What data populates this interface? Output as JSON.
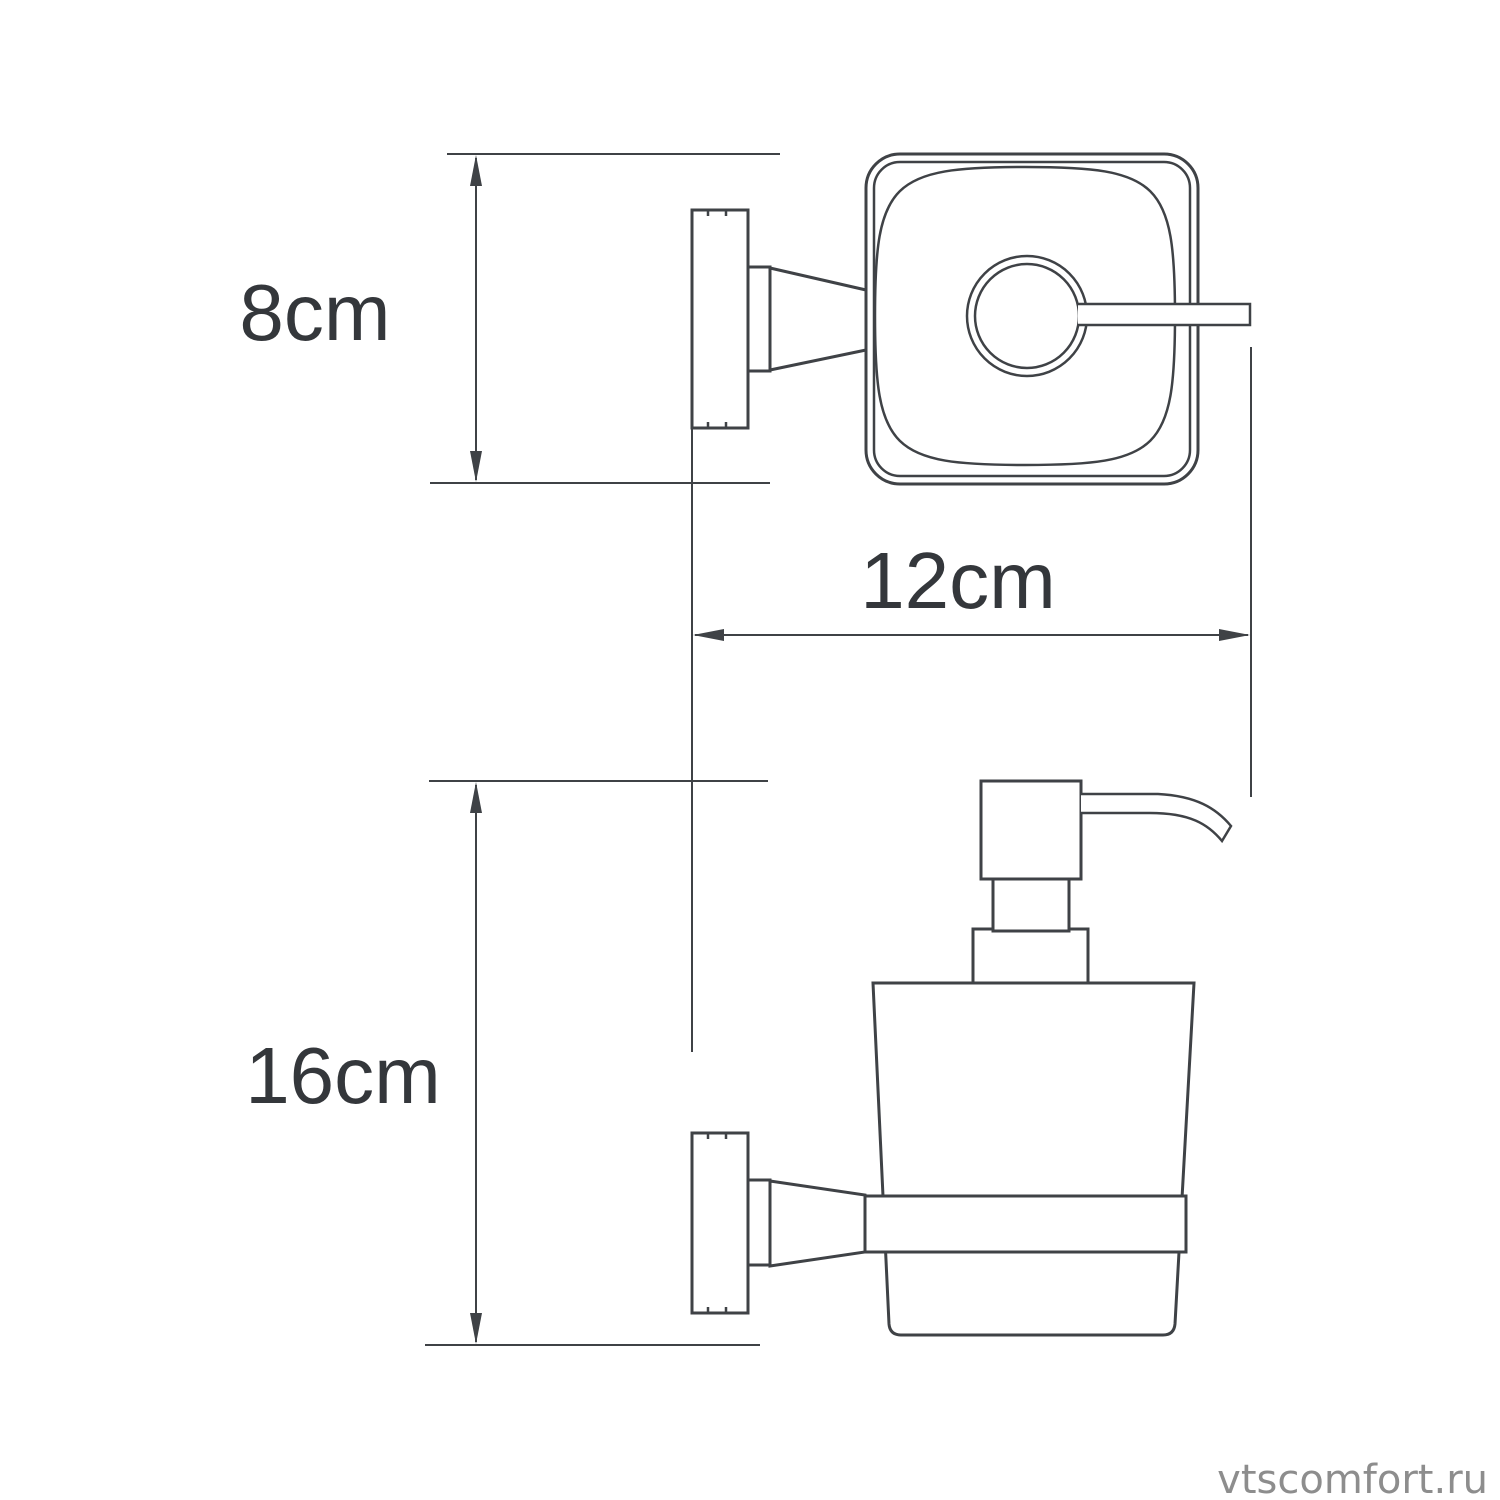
{
  "colors": {
    "line": "#3f4246",
    "text": "#34373b",
    "watermark": "#8d8d8d",
    "bg": "#ffffff"
  },
  "drawing": {
    "type": "technical-dimension-diagram",
    "product": "wall-mounted soap dispenser (top view and side view)",
    "dimensions": [
      {
        "id": "top-view-depth",
        "label": "8cm",
        "orientation": "vertical"
      },
      {
        "id": "wall-to-spout-width",
        "label": "12cm",
        "orientation": "horizontal"
      },
      {
        "id": "side-view-height",
        "label": "16cm",
        "orientation": "vertical"
      }
    ],
    "watermark": "vtscomfort.ru"
  }
}
